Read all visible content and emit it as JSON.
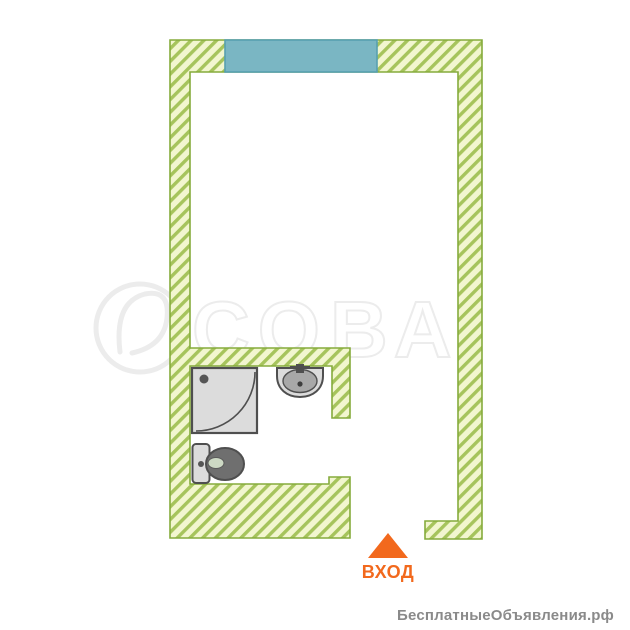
{
  "page": {
    "type": "floor-plan-image",
    "background": "#ffffff"
  },
  "colors": {
    "wall_fill": "#f2f6cf",
    "wall_hatch": "#a6c45c",
    "wall_border": "#85ab3c",
    "window_fill": "#7ab6c3",
    "window_border": "#57a0b0",
    "fixture_fill": "#dcdcdc",
    "fixture_stroke": "#4f4f4f",
    "fixture_dark": "#6f6f6f",
    "toilet_inner": "#cdd9c4",
    "entrance_accent": "#f2691d",
    "watermark_gray": "#ececec",
    "footer_gray": "#8a8a8a"
  },
  "plan": {
    "rooms": [
      "main-room",
      "bathroom"
    ],
    "fixtures": [
      "shower",
      "sink",
      "toilet"
    ],
    "window_count": 1,
    "entrance_label": "ВХОД"
  },
  "watermark": {
    "logo": "owl-in-circle",
    "text": "СОВА"
  },
  "footer": {
    "site_label": "БесплатныеОбъявления.рф"
  }
}
